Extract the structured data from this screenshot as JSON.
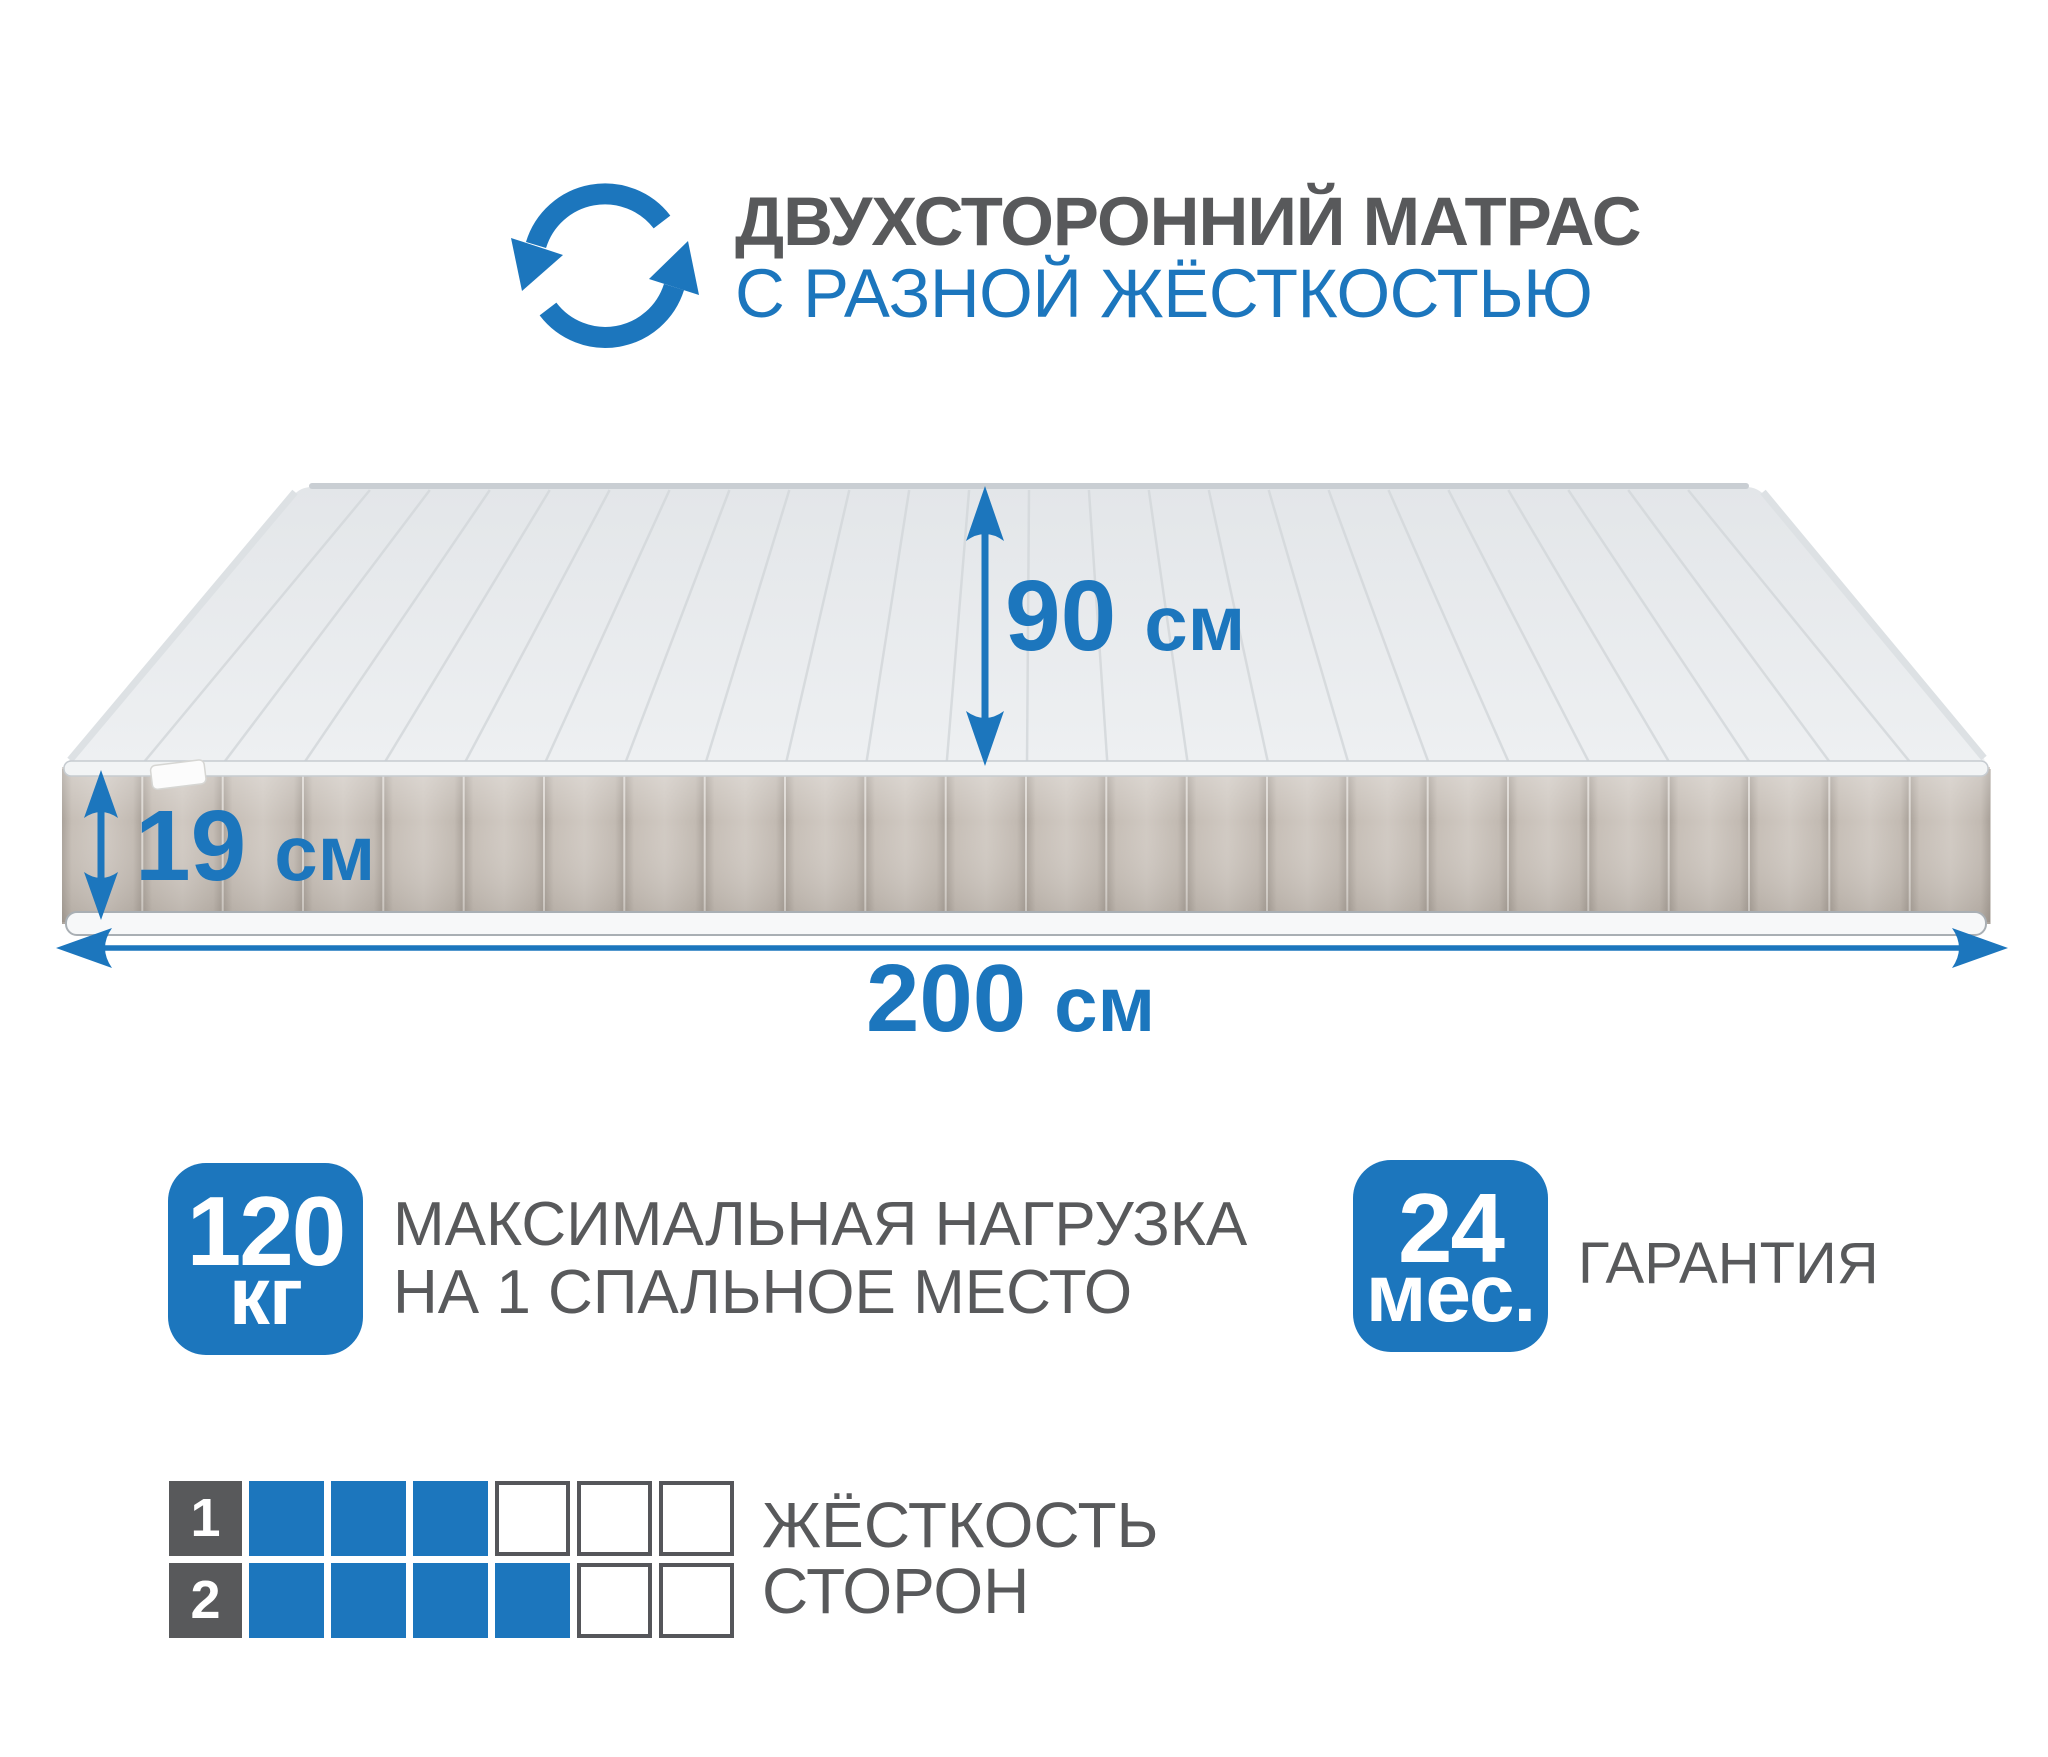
{
  "colors": {
    "accent_blue": "#1c76bd",
    "text_gray": "#58595b",
    "mattress_top": "#e9ebee",
    "mattress_side": "#c8c0b8"
  },
  "header": {
    "icon": "rotate-arrows",
    "title_line1": "ДВУХСТОРОННИЙ МАТРАС",
    "title_line2": "С РАЗНОЙ ЖЁСТКОСТЬЮ"
  },
  "dimensions": {
    "width": {
      "value": "90",
      "unit": "см"
    },
    "height": {
      "value": "19",
      "unit": "см"
    },
    "length": {
      "value": "200",
      "unit": "см"
    }
  },
  "badges": {
    "max_load": {
      "value": "120",
      "unit": "кг",
      "label_line1": "МАКСИМАЛЬНАЯ НАГРУЗКА",
      "label_line2": "НА 1 СПАЛЬНОЕ МЕСТО"
    },
    "warranty": {
      "value": "24",
      "unit": "мес.",
      "label": "ГАРАНТИЯ"
    }
  },
  "firmness": {
    "label_line1": "ЖЁСТКОСТЬ",
    "label_line2": "СТОРОН",
    "scale_max": 6,
    "sides": [
      {
        "side": "1",
        "level": 3
      },
      {
        "side": "2",
        "level": 4
      }
    ]
  }
}
